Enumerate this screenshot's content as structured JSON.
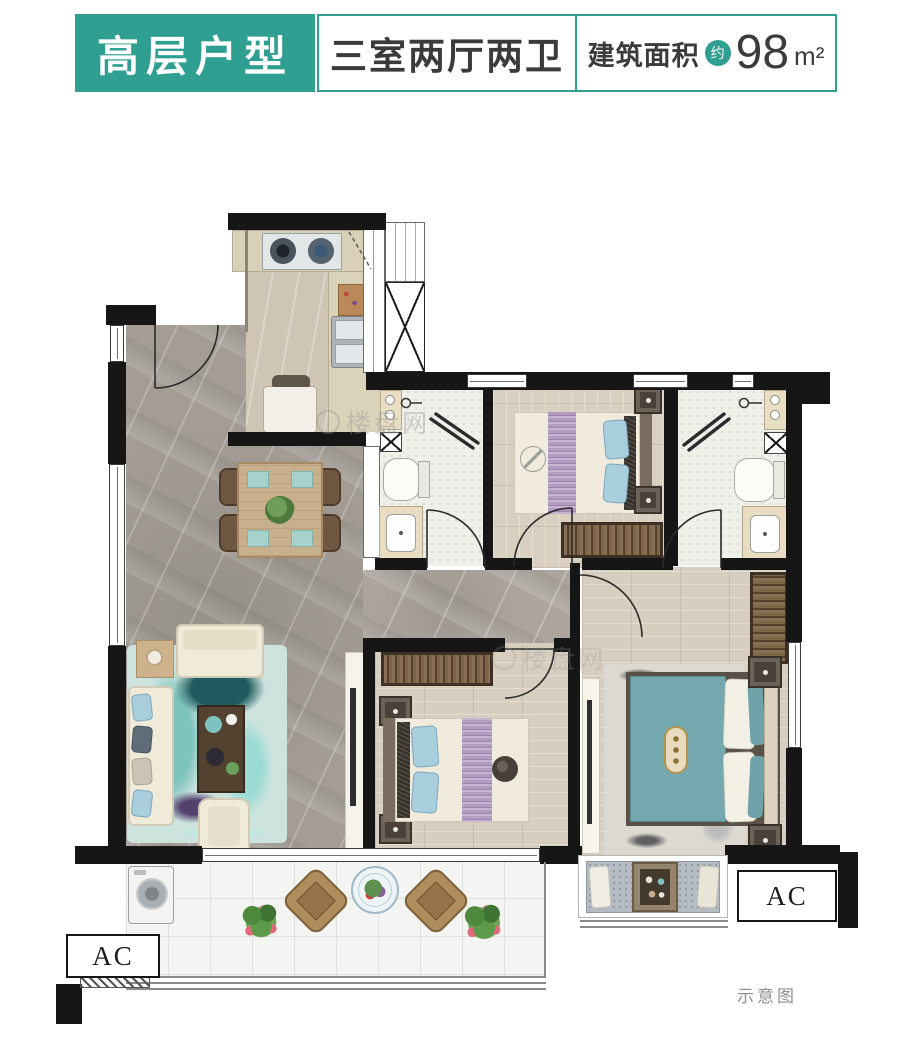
{
  "header": {
    "unit_type_label": "高层户型",
    "layout_label": "三室两厅两卫",
    "area_label": "建筑面积",
    "area_approx": "约",
    "area_value": "98",
    "area_unit": "m²"
  },
  "plan": {
    "ac_label_left": "AC",
    "ac_label_right": "AC",
    "note": "示意图",
    "watermark": "楼盘网"
  },
  "colors": {
    "teal": "#2f9f92",
    "wall": "#161616",
    "text_dark": "#3b3b3b",
    "note_gray": "#8f8f8f"
  }
}
